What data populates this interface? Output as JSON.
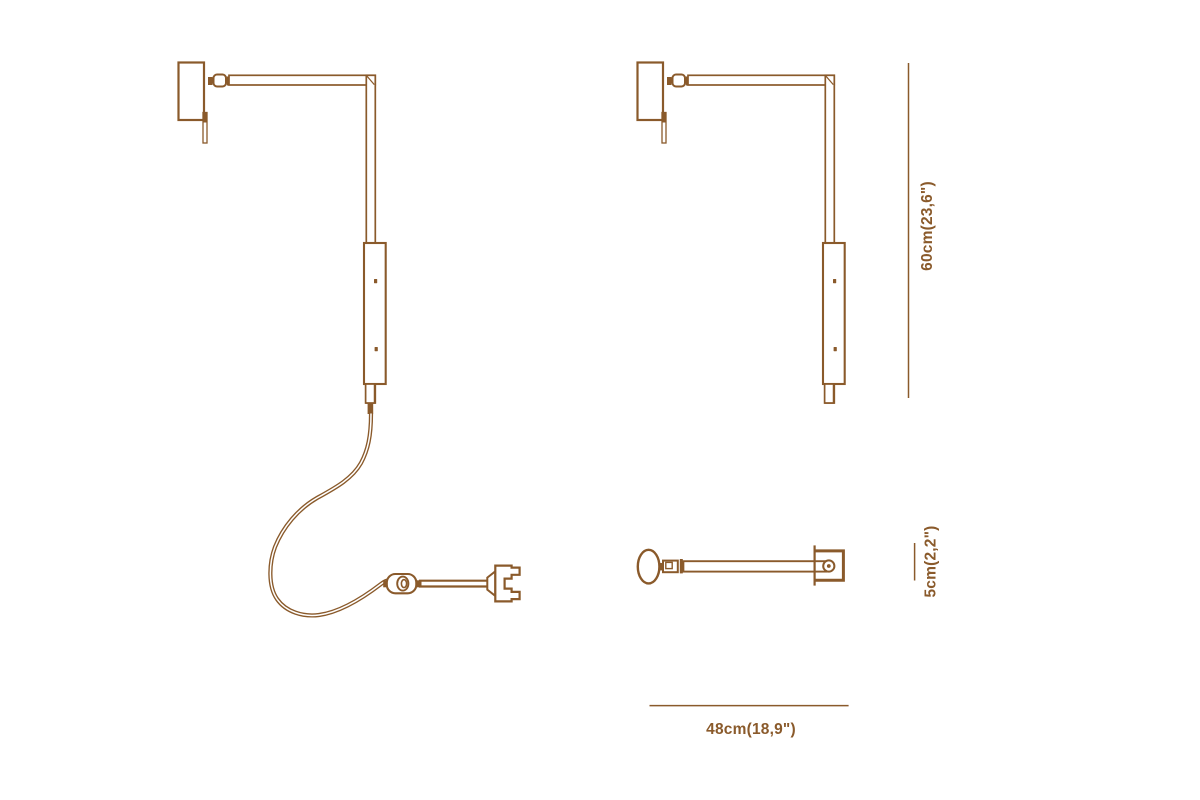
{
  "page": {
    "background_color": "#ffffff",
    "line_color": "#8a5a2b"
  },
  "dimensions": {
    "height": "60cm(23,6\")",
    "head": "5cm(2,2\")",
    "depth": "48cm(18,9\")"
  }
}
